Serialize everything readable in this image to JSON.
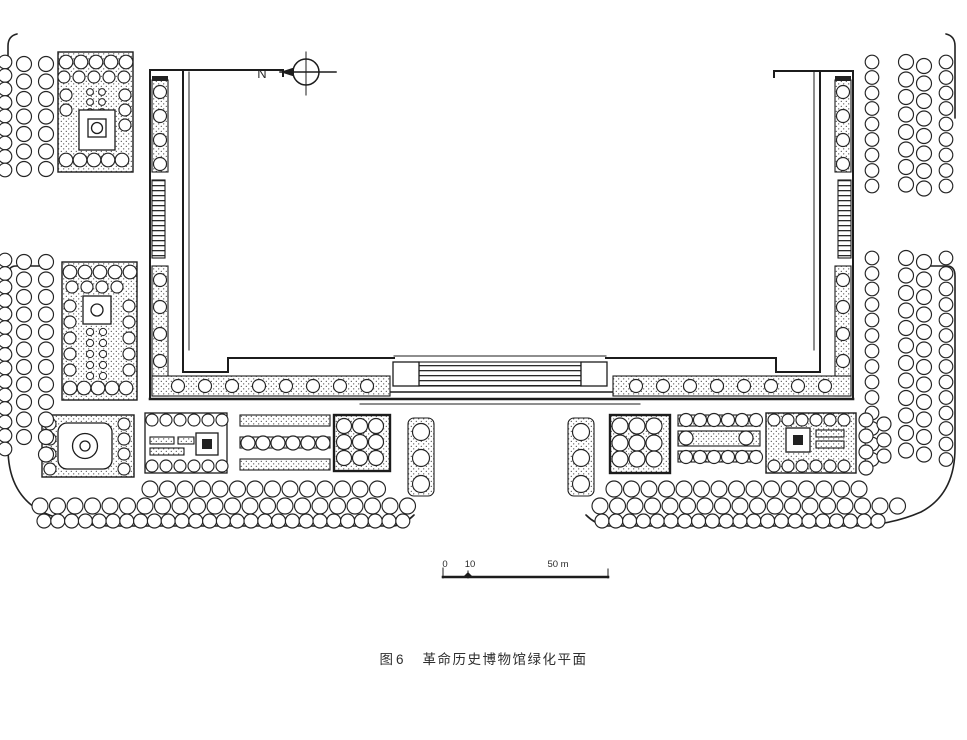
{
  "figure": {
    "north_label": "N",
    "scale_bar": {
      "tick_0": "0",
      "tick_10": "10",
      "tick_50": "50 m"
    },
    "caption": {
      "number": "图6",
      "title": "革命历史博物馆绿化平面"
    }
  },
  "colors": {
    "ink": "#1c1c1c",
    "paper": "#ffffff"
  }
}
